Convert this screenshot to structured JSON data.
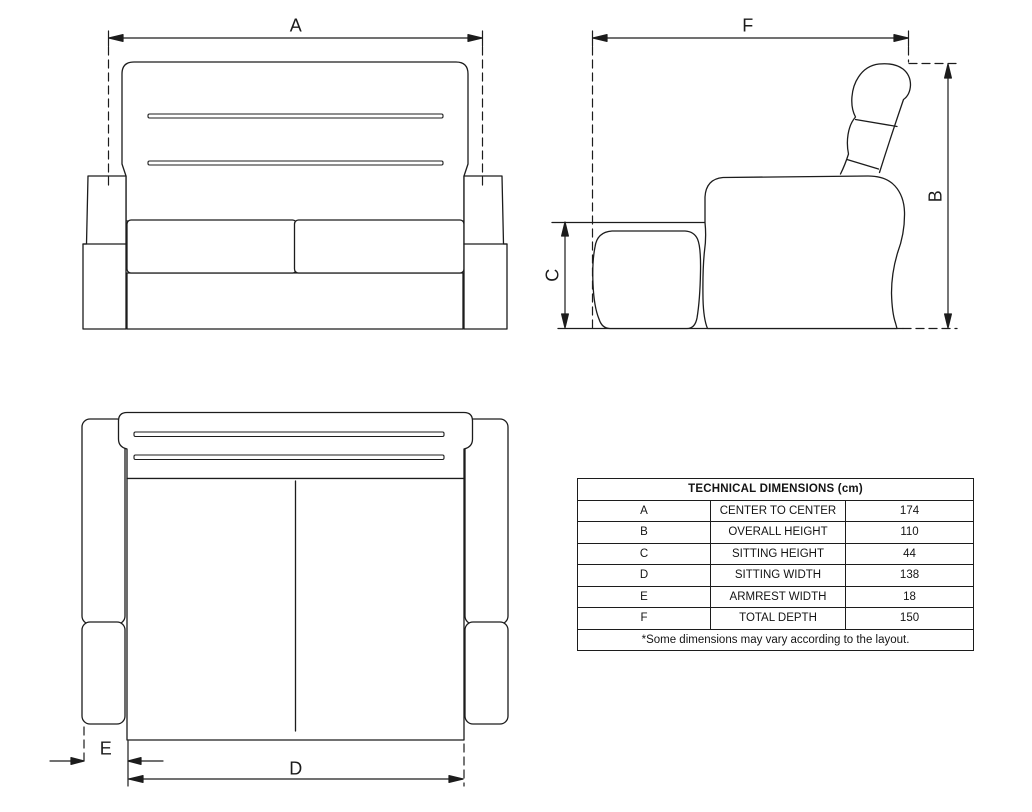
{
  "diagram": {
    "line_color": "#1c1c1c",
    "background_color": "#ffffff",
    "labels": {
      "a": "A",
      "b": "B",
      "c": "C",
      "d": "D",
      "e": "E",
      "f": "F"
    }
  },
  "table": {
    "title": "TECHNICAL DIMENSIONS (cm)",
    "rows": [
      {
        "letter": "A",
        "name": "CENTER TO CENTER",
        "value": "174"
      },
      {
        "letter": "B",
        "name": "OVERALL HEIGHT",
        "value": "110"
      },
      {
        "letter": "C",
        "name": "SITTING HEIGHT",
        "value": "44"
      },
      {
        "letter": "D",
        "name": "SITTING WIDTH",
        "value": "138"
      },
      {
        "letter": "E",
        "name": "ARMREST WIDTH",
        "value": "18"
      },
      {
        "letter": "F",
        "name": "TOTAL DEPTH",
        "value": "150"
      }
    ],
    "footnote": "*Some dimensions may vary according to the layout."
  }
}
